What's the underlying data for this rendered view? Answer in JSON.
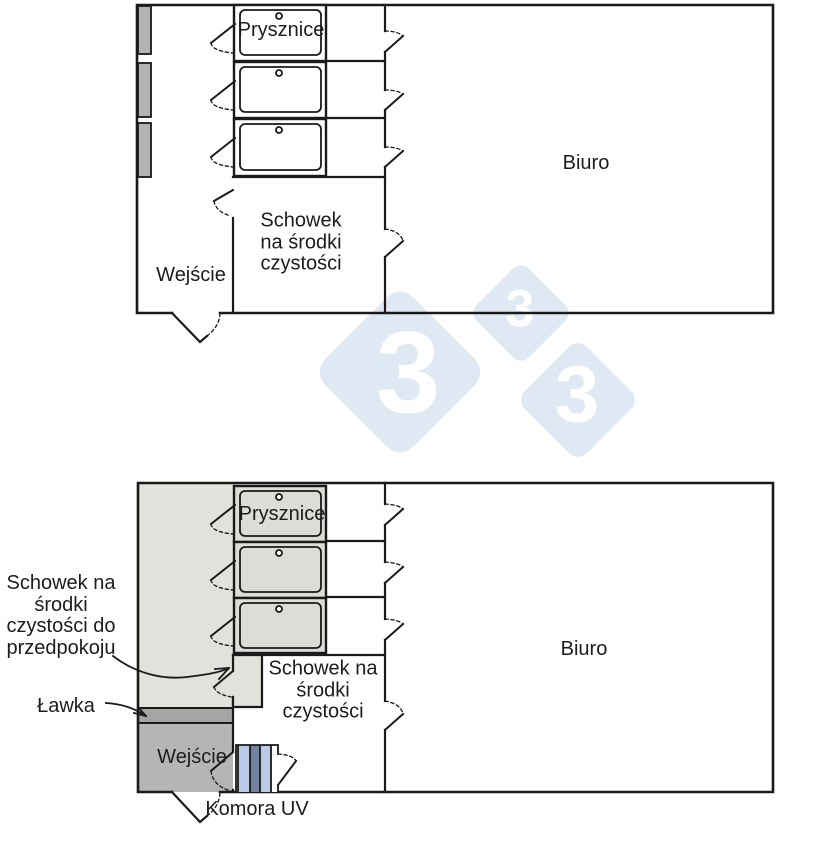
{
  "watermark": {
    "digit": "3"
  },
  "colors": {
    "wall": "#1a1a1a",
    "locker_gray": "#b3b3b3",
    "anteroom_gray": "#e1e2db",
    "stall_gray": "#dcddd6",
    "bench_gray": "#a5a5a5",
    "entry_gray": "#b5b5b5",
    "uv_light": "#b9cbe8",
    "uv_dark": "#72839f",
    "watermark_blue": "#dfe9f4",
    "watermark_digit": "#ffffff",
    "white": "#ffffff"
  },
  "plan_top": {
    "prysznice_label": "Prysznice",
    "schowek_label": "Schowek\nna środki\nczystości",
    "wejscie_label": "Wejście",
    "biuro_label": "Biuro"
  },
  "plan_bottom": {
    "prysznice_label": "Prysznice",
    "schowek_label": "Schowek na\nśrodki\nczystości",
    "biuro_label": "Biuro",
    "wejscie_label": "Wejście",
    "komora_label": "Komora UV",
    "lawka_label": "Ławka",
    "ext_schowek_label": "Schowek na\nśrodki\nczystości do\nprzedpokoju"
  }
}
